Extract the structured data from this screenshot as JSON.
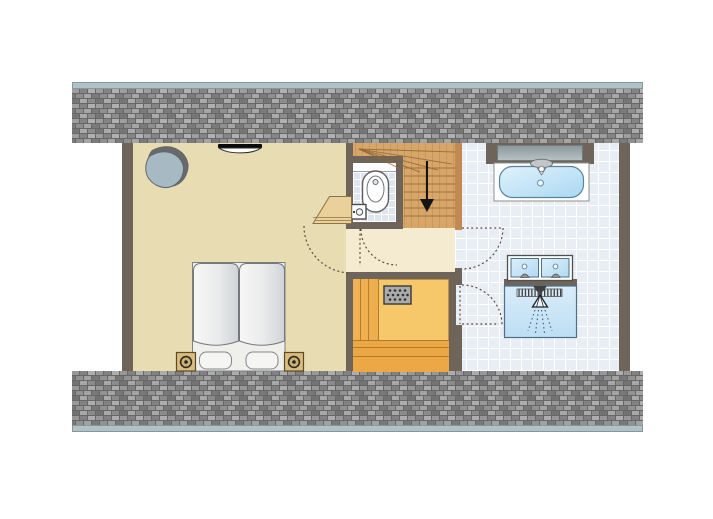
{
  "plan": {
    "type": "floor-plan",
    "title": "Attic floor plan",
    "view": "top-down"
  },
  "colors": {
    "wall": "#6e6459",
    "bedroom_floor": "#e8dcb2",
    "hall_floor": "#f4ebd0",
    "tile_base": "#e9edf4",
    "tile_line": "#ffffff",
    "wood": "#d8a668",
    "wood_wall": "#c18a52",
    "sauna_floor": "#f7c869",
    "sauna_bench": "#f0b255",
    "sauna_bench_deep": "#eda846",
    "roof_strip": "#b2c1c6",
    "water": "#b9e0f5",
    "arrow": "#141414"
  },
  "rooms": {
    "bedroom": {
      "label": "Bedroom",
      "furniture": [
        "armchair",
        "radiator",
        "twin beds",
        "nightstand with lamp (left)",
        "nightstand with lamp (right)",
        "corner desk"
      ]
    },
    "toilet": {
      "label": "Toilet",
      "fixtures": [
        "toilet",
        "hand basin"
      ]
    },
    "staircase": {
      "label": "Staircase",
      "direction": "down",
      "features": [
        "winder steps",
        "down arrow"
      ]
    },
    "landing": {
      "label": "Landing"
    },
    "sauna": {
      "label": "Sauna",
      "fixtures": [
        "sauna heater",
        "benches"
      ]
    },
    "bathroom": {
      "label": "Bathroom",
      "fixtures": [
        "bathtub with faucet",
        "window above bath",
        "double washbasin",
        "shower with head and drain grate"
      ]
    }
  },
  "doors": {
    "bedroom_door": "swings into bedroom",
    "toilet_door": "swings into landing",
    "bathroom_upper_door": "swings into bathroom",
    "bathroom_lower_door": "swings into bathroom"
  },
  "structure": {
    "roof_band_top": "hatched roof/brick texture",
    "roof_band_bottom": "hatched roof/brick texture"
  }
}
